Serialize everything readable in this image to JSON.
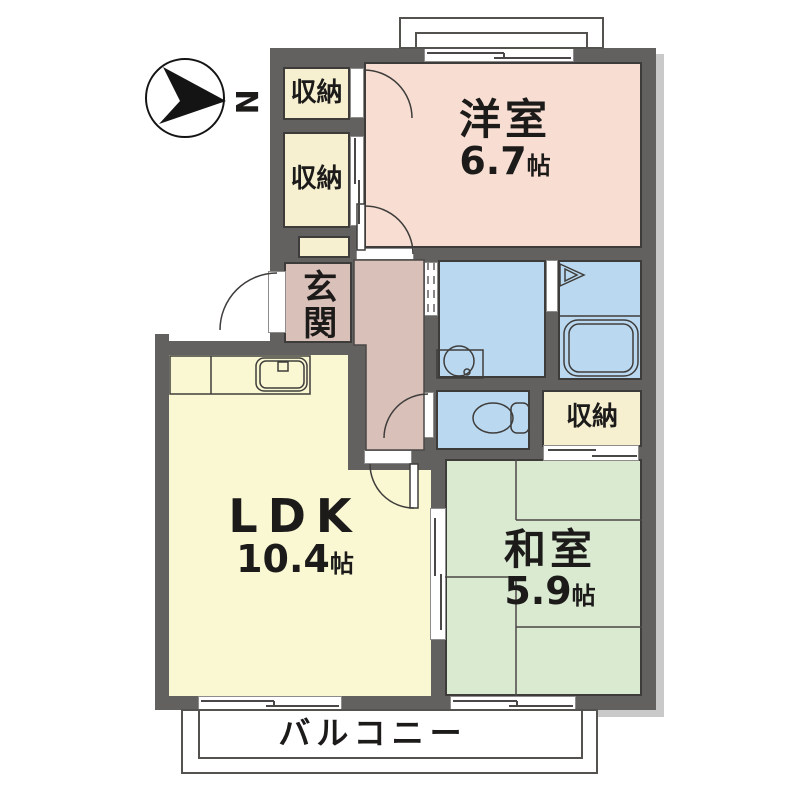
{
  "compass": {
    "north_label": "N"
  },
  "rooms": {
    "western_room": {
      "name": "洋室",
      "area": "6.7",
      "area_unit": "帖"
    },
    "ldk": {
      "name": "LDK",
      "area": "10.4",
      "area_unit": "帖"
    },
    "japanese_room": {
      "name": "和室",
      "area": "5.9",
      "area_unit": "帖"
    },
    "entrance": {
      "name": "玄関"
    },
    "closet_top": {
      "name": "収納"
    },
    "closet_mid": {
      "name": "収納"
    },
    "closet_east": {
      "name": "収納"
    },
    "balcony": {
      "name": "バルコニー"
    }
  },
  "colors": {
    "wall": "#636160",
    "line": "#3e3c3a",
    "western_room": "#f8ded2",
    "closet": "#f6f0d1",
    "entrance_hall": "#d9c0b9",
    "wet_area": "#bad9f0",
    "ldk": "#f9f8d2",
    "japanese_room": "#d9ead1"
  }
}
